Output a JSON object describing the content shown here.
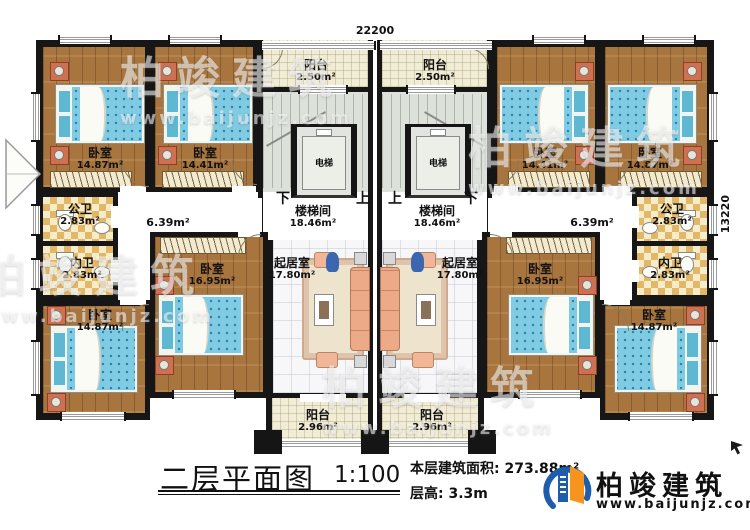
{
  "dimensions": {
    "top": "22200",
    "right": "13220"
  },
  "rooms": {
    "balcony_top": {
      "name": "阳台",
      "area": "2.50m²"
    },
    "balcony_bottom": {
      "name": "阳台",
      "area": "2.96m²"
    },
    "stairwell": {
      "name": "楼梯间",
      "area": "18.46m²"
    },
    "elevator": {
      "name": "电梯"
    },
    "corridor": {
      "area": "6.39m²"
    },
    "bedroom_a": {
      "name": "卧室",
      "area": "14.87m²"
    },
    "bedroom_b": {
      "name": "卧室",
      "area": "14.41m²"
    },
    "bedroom_c": {
      "name": "卧室",
      "area": "16.95m²"
    },
    "bedroom_d": {
      "name": "卧室",
      "area": "14.87m²"
    },
    "public_bath": {
      "name": "公卫",
      "area": "2.83m²"
    },
    "inner_bath": {
      "name": "内卫",
      "area": "2.83m²"
    },
    "living": {
      "name": "起居室",
      "area": "17.80m²"
    }
  },
  "stairs": {
    "down": "下",
    "up": "上"
  },
  "titleblock": {
    "title": "二层平面图",
    "scale": "1:100",
    "floor_area_label": "本层建筑面积:",
    "floor_area_value": "273.88m²",
    "floor_height_label": "层高:",
    "floor_height_value": "3.3m"
  },
  "brand": {
    "name": "柏竣建筑",
    "url": "www.baijunjz.com"
  },
  "watermark": {
    "name": "柏竣建筑",
    "url": "www.baijunjz.com"
  },
  "colors": {
    "wall": "#161616",
    "wood_floor": "#a8753f",
    "bed_blue": "#7fcbe4",
    "brand_blue": "#1d5dab",
    "brand_orange": "#f7941e"
  }
}
